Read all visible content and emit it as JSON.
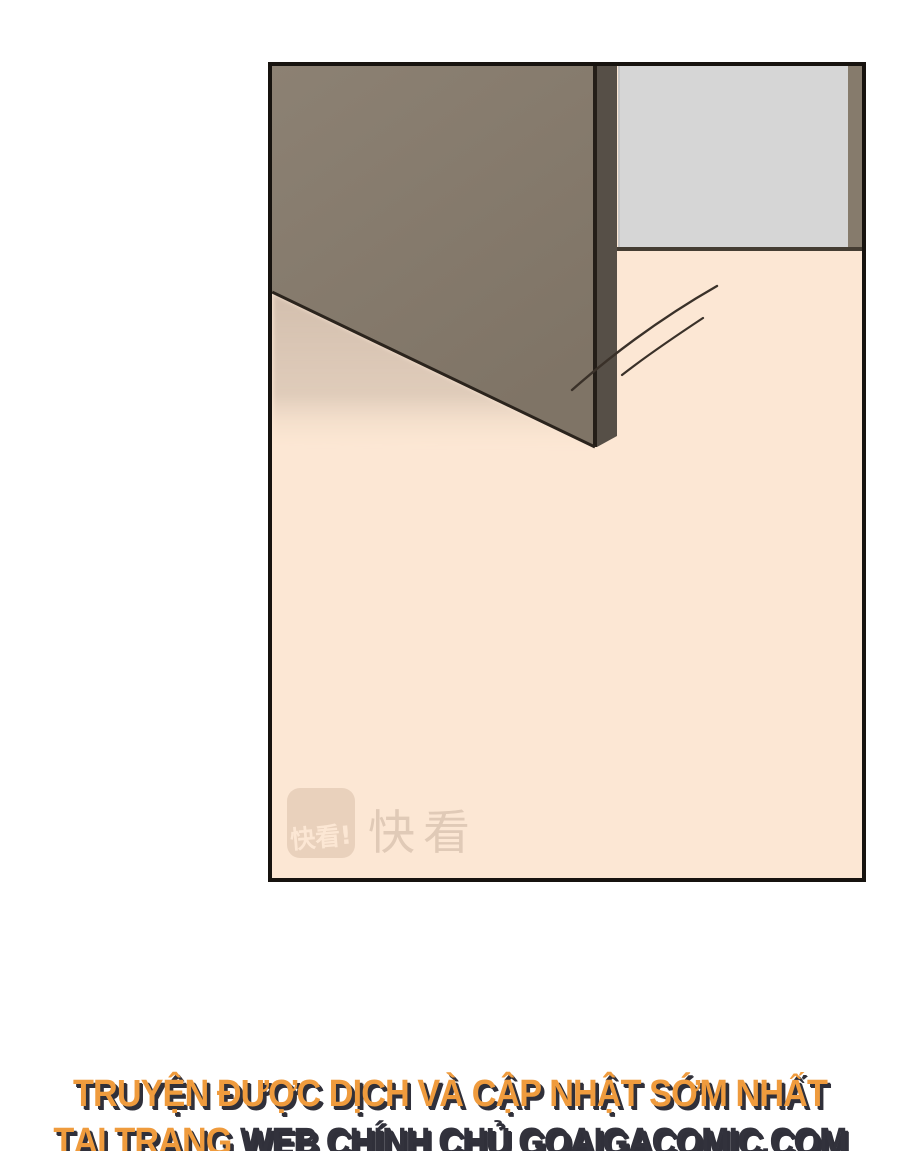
{
  "page": {
    "background_color": "#FFFFFF"
  },
  "panel": {
    "description": "comic panel: open door swinging over a cream floor, gray wall section behind",
    "border_color": "#17130F",
    "floor_color": "#FCE7D4",
    "door_face_color": "#877C6F",
    "door_edge_color": "#564F47",
    "door_frame_color": "#867B6C",
    "wall_color": "#D6D6D6",
    "outline_color": "#241E18",
    "shadow_color": "#D5C2B2",
    "motion_line_color": "#3A3129",
    "watermark": {
      "logo_badge_text": "快看!",
      "brand_text": "快看",
      "badge_color": "#E7CFBA",
      "text_color": "#DEC7B4"
    }
  },
  "footer": {
    "line1": "TRUYỆN ĐƯỢC DỊCH VÀ CẬP NHẬT SỚM NHẤT",
    "line2_prefix": "TẠI TRANG ",
    "line2_site": "WEB CHÍNH CHỦ GOAIGACOMIC.COM",
    "text_color": "#EF9B3D",
    "shadow_color": "#30303A",
    "site_text_color": "#32323C"
  }
}
